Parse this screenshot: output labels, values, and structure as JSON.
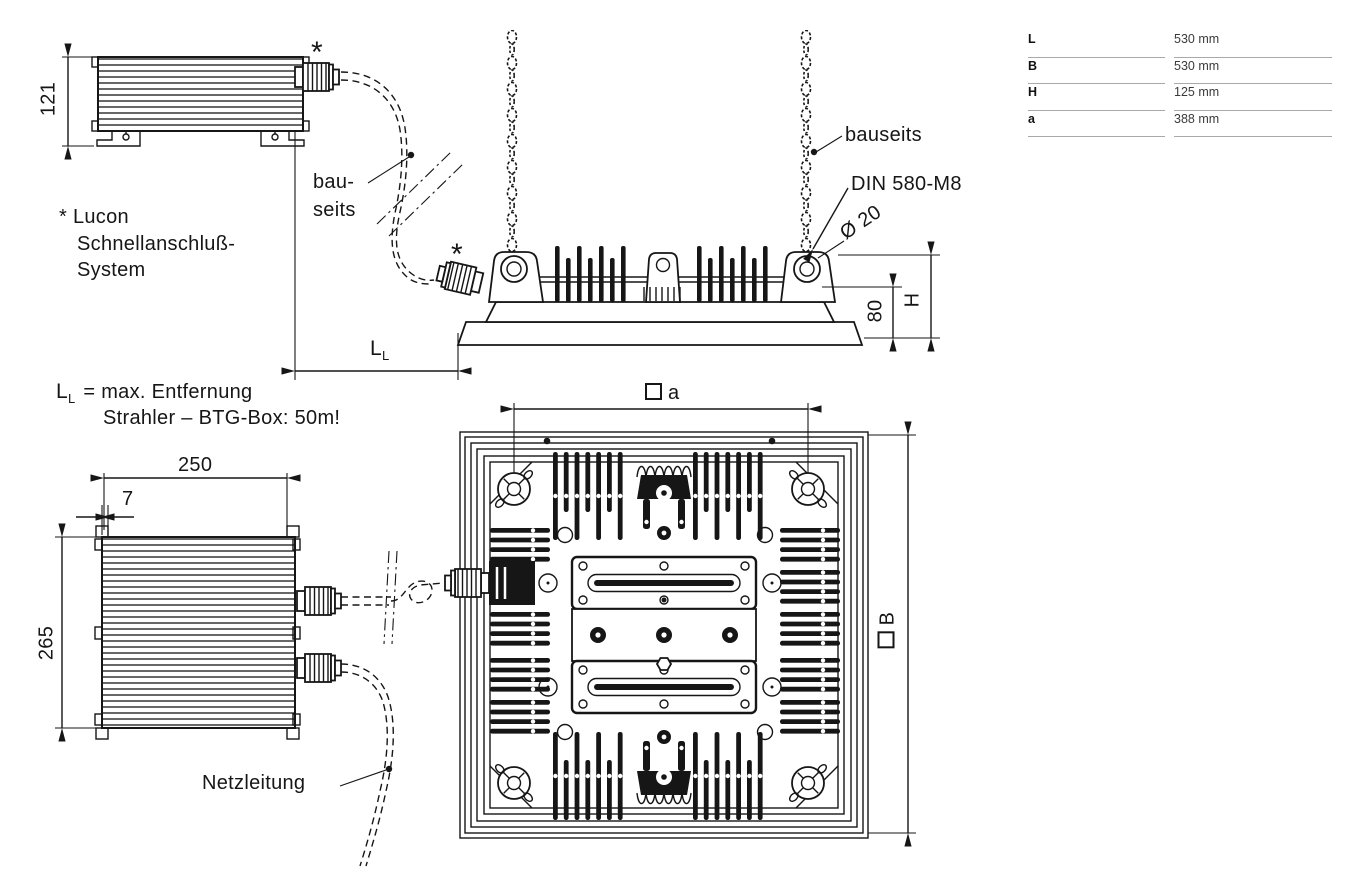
{
  "spec_table": {
    "rows": [
      {
        "label": "L",
        "value": "530 mm"
      },
      {
        "label": "B",
        "value": "530 mm"
      },
      {
        "label": "H",
        "value": "125 mm"
      },
      {
        "label": "a",
        "value": "388 mm"
      }
    ]
  },
  "notes": {
    "lucon_line1": "* Lucon",
    "lucon_line2": "Schnellanschluß-",
    "lucon_line3": "System",
    "ll_symbol": "L",
    "ll_symbol_sub": "L",
    "ll_line1_rest": "= max. Entfernung",
    "ll_line2": "Strahler – BTG-Box: 50m!"
  },
  "callouts": {
    "asterisk_btg": "*",
    "asterisk_floodlight": "*",
    "bauseits_wrapped_1": "bau-",
    "bauseits_wrapped_2": "seits",
    "bauseits": "bauseits",
    "din": "DIN 580-M8",
    "diameter": "Ø 20",
    "netzleitung": "Netzleitung"
  },
  "dims": {
    "btg_height": "121",
    "btg_width": "250",
    "btg_lid_offset": "7",
    "btg_front_height": "265",
    "mount_height": "80",
    "total_height": "H",
    "cable_len_main": "L",
    "cable_len_sub": "L",
    "hole_spacing": "a",
    "width_letter": "B"
  }
}
